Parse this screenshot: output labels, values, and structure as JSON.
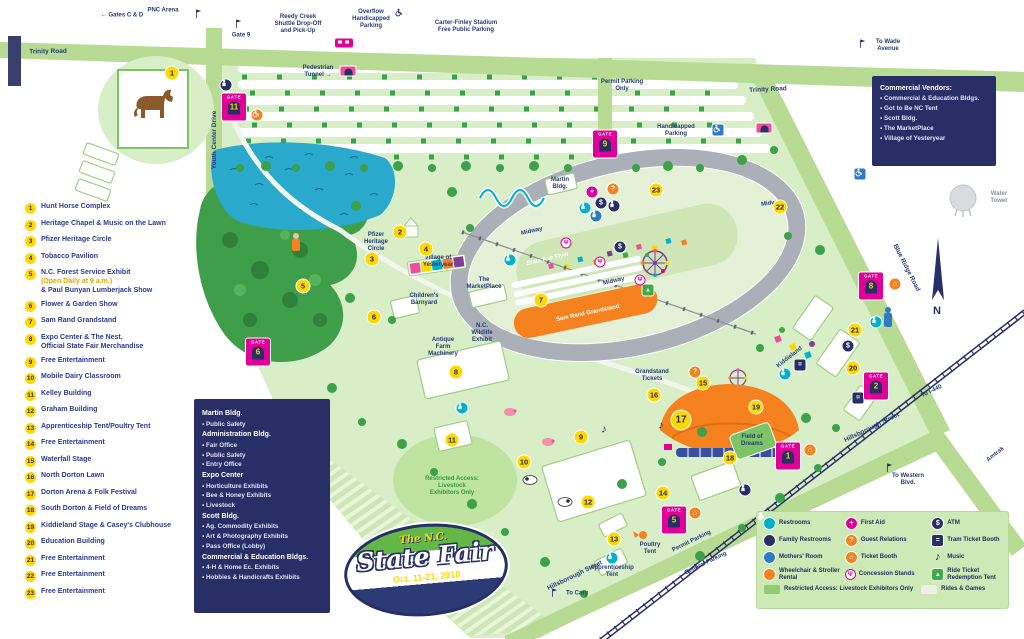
{
  "colors": {
    "navy": "#272f66",
    "magenta": "#e10098",
    "yellow": "#ffd800",
    "orange": "#f5821f",
    "teal": "#00b2c9",
    "blue": "#2e7bc4",
    "green": "#3faa4a",
    "road_green": "#b7db93",
    "fairground_green": "#d8eec6",
    "lake_blue": "#29a9cc"
  },
  "logo": {
    "top": "The N.C.",
    "main": "State Fair",
    "date": "Oct. 11-21, 2018"
  },
  "key": [
    {
      "n": "1",
      "label": "Hunt Horse Complex"
    },
    {
      "n": "2",
      "label": "Heritage Chapel & Music on the Lawn"
    },
    {
      "n": "3",
      "label": "Pfizer Heritage Circle"
    },
    {
      "n": "4",
      "label": "Tobacco Pavilion"
    },
    {
      "n": "5",
      "label": "N.C. Forest Service Exhibit",
      "note": "(Open Daily at 9 a.m.)",
      "label2": "& Paul Bunyan Lumberjack Show"
    },
    {
      "n": "6",
      "label": "Flower & Garden Show"
    },
    {
      "n": "7",
      "label": "Sam Rand Grandstand"
    },
    {
      "n": "8",
      "label": "Expo Center & The Nest,\nOfficial State Fair Merchandise"
    },
    {
      "n": "9",
      "label": "Free Entertainment"
    },
    {
      "n": "10",
      "label": "Mobile Dairy Classroom"
    },
    {
      "n": "11",
      "label": "Kelley Building"
    },
    {
      "n": "12",
      "label": "Graham Building"
    },
    {
      "n": "13",
      "label": "Apprenticeship Tent/Poultry Tent"
    },
    {
      "n": "14",
      "label": "Free Entertainment"
    },
    {
      "n": "15",
      "label": "Waterfall Stage"
    },
    {
      "n": "16",
      "label": "North Dorton Lawn"
    },
    {
      "n": "17",
      "label": "Dorton Arena & Folk Festival"
    },
    {
      "n": "18",
      "label": "South Dorton & Field of Dreams"
    },
    {
      "n": "19",
      "label": "Kiddieland Stage & Casey's Clubhouse"
    },
    {
      "n": "20",
      "label": "Education Building"
    },
    {
      "n": "21",
      "label": "Free Entertainment"
    },
    {
      "n": "22",
      "label": "Free Entertainment"
    },
    {
      "n": "23",
      "label": "Free Entertainment"
    }
  ],
  "buildings_box": {
    "groups": [
      {
        "name": "Martin Bldg.",
        "items": [
          "Public Safety"
        ]
      },
      {
        "name": "Administration Bldg.",
        "items": [
          "Fair Office",
          "Public Safety",
          "Entry Office"
        ]
      },
      {
        "name": "Expo Center",
        "items": [
          "Horticulture Exhibits",
          "Bee & Honey Exhibits",
          "Livestock"
        ]
      },
      {
        "name": "Scott Bldg.",
        "items": [
          "Ag. Commodity Exhibits",
          "Art & Photography Exhibits",
          "Pass Office (Lobby)"
        ]
      },
      {
        "name": "Commercial & Education Bldgs.",
        "items": [
          "4-H & Home Ec. Exhibits",
          "Hobbies & Handicrafts Exhibits"
        ]
      }
    ]
  },
  "vendors_box": {
    "title": "Commercial Vendors:",
    "items": [
      "Commercial & Education Bldgs.",
      "Got to Be NC Tent",
      "Scott Bldg.",
      "The MarketPlace",
      "Village of Yesteryear"
    ]
  },
  "legend": {
    "items": [
      {
        "type": "rr",
        "label": "Restrooms"
      },
      {
        "type": "aid",
        "label": "First Aid"
      },
      {
        "type": "atm",
        "label": "ATM"
      },
      {
        "type": "fam",
        "label": "Family Restrooms"
      },
      {
        "type": "gr",
        "label": "Guest Relations"
      },
      {
        "type": "tram",
        "label": "Tram Ticket Booth"
      },
      {
        "type": "mom",
        "label": "Mothers' Room"
      },
      {
        "type": "tk",
        "label": "Ticket Booth"
      },
      {
        "type": "music",
        "label": "Music"
      },
      {
        "type": "wc",
        "label": "Wheelchair & Stroller Rental"
      },
      {
        "type": "con",
        "label": "Concession Stands"
      },
      {
        "type": "ride",
        "label": "Ride Ticket Redemption Tent"
      }
    ],
    "swatches": [
      {
        "label": "Restricted Access: Livestock Exhibitors Only",
        "color": "#93cc72"
      },
      {
        "label": "Rides & Games",
        "color": "#edf1e4"
      }
    ]
  },
  "labels": [
    {
      "t": "← Gates C & D",
      "x": 122,
      "y": 16
    },
    {
      "t": "PNC Arena",
      "x": 163,
      "y": 11
    },
    {
      "t": "Gate 9",
      "x": 241,
      "y": 36
    },
    {
      "t": "Reedy Creek\nShuttle Drop-Off\nand Pick-Up",
      "x": 298,
      "y": 25
    },
    {
      "t": "Overflow\nHandicapped\nParking",
      "x": 371,
      "y": 20
    },
    {
      "t": "Carter-Finley Stadium\nFree Public Parking",
      "x": 466,
      "y": 27
    },
    {
      "t": "To Wade\nAvenue",
      "x": 888,
      "y": 46
    },
    {
      "t": "Trinity Road",
      "x": 48,
      "y": 52,
      "r": -1,
      "c": "road"
    },
    {
      "t": "Trinity Road",
      "x": 768,
      "y": 90,
      "r": -3,
      "c": "road"
    },
    {
      "t": "Youth Center Drive",
      "x": 215,
      "y": 140,
      "r": -90,
      "c": "road"
    },
    {
      "t": "Blue Ridge Road",
      "x": 906,
      "y": 268,
      "r": 63,
      "c": "road"
    },
    {
      "t": "Hillsborough Street",
      "x": 575,
      "y": 576,
      "r": -26,
      "c": "road"
    },
    {
      "t": "Hillsborough Street",
      "x": 872,
      "y": 428,
      "r": -26,
      "c": "road"
    },
    {
      "t": "To Cary",
      "x": 577,
      "y": 594
    },
    {
      "t": "To Western\nBlvd.",
      "x": 908,
      "y": 480
    },
    {
      "t": "To I-440",
      "x": 932,
      "y": 392,
      "r": -26
    },
    {
      "t": "Permit Parking",
      "x": 692,
      "y": 542,
      "r": -26
    },
    {
      "t": "General Parking",
      "x": 706,
      "y": 564,
      "r": -26
    },
    {
      "t": "Amtrak",
      "x": 996,
      "y": 455,
      "r": -38
    },
    {
      "t": "Pedestrian\nTunnel →",
      "x": 318,
      "y": 72
    },
    {
      "t": "Water Tower",
      "x": 999,
      "y": 198,
      "c": "gray"
    },
    {
      "t": "Handicapped\nParking",
      "x": 676,
      "y": 131
    },
    {
      "t": "Permit Parking\nOnly",
      "x": 622,
      "y": 86
    },
    {
      "t": "Martin\nBldg.",
      "x": 560,
      "y": 184
    },
    {
      "t": "Midway",
      "x": 532,
      "y": 232,
      "r": -13
    },
    {
      "t": "State Fair Flyer",
      "x": 548,
      "y": 260,
      "r": -13,
      "c": "white"
    },
    {
      "t": "Midway",
      "x": 614,
      "y": 282,
      "r": -13
    },
    {
      "t": "Midway",
      "x": 772,
      "y": 204,
      "r": -8
    },
    {
      "t": "Sam Rand Grandstand",
      "x": 588,
      "y": 314,
      "r": -12,
      "c": "white"
    },
    {
      "t": "Pfizer\nHeritage\nCircle",
      "x": 376,
      "y": 243
    },
    {
      "t": "Village of\nYesteryear",
      "x": 438,
      "y": 262
    },
    {
      "t": "The\nMarketPlace",
      "x": 484,
      "y": 284
    },
    {
      "t": "Children's\nBarnyard",
      "x": 424,
      "y": 300
    },
    {
      "t": "N.C.\nWildlife\nExhibit",
      "x": 482,
      "y": 334
    },
    {
      "t": "Antique\nFarm\nMachinery",
      "x": 443,
      "y": 348
    },
    {
      "t": "Grandstand\nTickets",
      "x": 652,
      "y": 376
    },
    {
      "t": "Field of\nDreams",
      "x": 752,
      "y": 441
    },
    {
      "t": "Kiddieland",
      "x": 790,
      "y": 358,
      "r": -38
    },
    {
      "t": "Restricted Access:\nLivestock\nExhibitors Only",
      "x": 452,
      "y": 487,
      "c": "green"
    },
    {
      "t": "Apprenticeship\nTent",
      "x": 612,
      "y": 572
    },
    {
      "t": "Poultry\nTent",
      "x": 650,
      "y": 549
    }
  ],
  "numbers": [
    {
      "n": "1",
      "x": 172,
      "y": 73
    },
    {
      "n": "2",
      "x": 400,
      "y": 232
    },
    {
      "n": "3",
      "x": 372,
      "y": 259
    },
    {
      "n": "4",
      "x": 426,
      "y": 249
    },
    {
      "n": "5",
      "x": 303,
      "y": 286
    },
    {
      "n": "6",
      "x": 374,
      "y": 317
    },
    {
      "n": "7",
      "x": 541,
      "y": 300
    },
    {
      "n": "8",
      "x": 456,
      "y": 372
    },
    {
      "n": "9",
      "x": 581,
      "y": 437
    },
    {
      "n": "10",
      "x": 524,
      "y": 462
    },
    {
      "n": "11",
      "x": 452,
      "y": 440
    },
    {
      "n": "12",
      "x": 588,
      "y": 502
    },
    {
      "n": "13",
      "x": 614,
      "y": 539
    },
    {
      "n": "14",
      "x": 663,
      "y": 493
    },
    {
      "n": "15",
      "x": 703,
      "y": 383
    },
    {
      "n": "16",
      "x": 654,
      "y": 395
    },
    {
      "n": "17",
      "x": 681,
      "y": 420,
      "s": 19
    },
    {
      "n": "18",
      "x": 730,
      "y": 458
    },
    {
      "n": "19",
      "x": 756,
      "y": 407
    },
    {
      "n": "20",
      "x": 853,
      "y": 368
    },
    {
      "n": "21",
      "x": 855,
      "y": 330
    },
    {
      "n": "22",
      "x": 780,
      "y": 207
    },
    {
      "n": "23",
      "x": 656,
      "y": 190
    }
  ],
  "gates": [
    {
      "n": "11",
      "x": 234,
      "y": 107
    },
    {
      "n": "9",
      "x": 605,
      "y": 144
    },
    {
      "n": "6",
      "x": 258,
      "y": 352
    },
    {
      "n": "8",
      "x": 871,
      "y": 286
    },
    {
      "n": "2",
      "x": 876,
      "y": 386
    },
    {
      "n": "1",
      "x": 788,
      "y": 456
    },
    {
      "n": "5",
      "x": 674,
      "y": 520
    }
  ],
  "icons": [
    {
      "t": "flag",
      "x": 200,
      "y": 14
    },
    {
      "t": "flag",
      "x": 240,
      "y": 24
    },
    {
      "t": "flag",
      "x": 864,
      "y": 44
    },
    {
      "t": "flag",
      "x": 556,
      "y": 593
    },
    {
      "t": "flag",
      "x": 891,
      "y": 468
    },
    {
      "t": "wc-navy",
      "x": 400,
      "y": 14
    },
    {
      "t": "wc-blue",
      "x": 718,
      "y": 130
    },
    {
      "t": "wc-blue",
      "x": 860,
      "y": 174
    },
    {
      "t": "tunnel",
      "x": 348,
      "y": 71
    },
    {
      "t": "tunnel",
      "x": 764,
      "y": 128
    },
    {
      "t": "bus",
      "x": 344,
      "y": 43
    },
    {
      "t": "rr",
      "x": 510,
      "y": 260
    },
    {
      "t": "rr",
      "x": 585,
      "y": 208
    },
    {
      "t": "rr",
      "x": 785,
      "y": 374
    },
    {
      "t": "rr",
      "x": 612,
      "y": 558
    },
    {
      "t": "rr",
      "x": 462,
      "y": 408
    },
    {
      "t": "rr",
      "x": 876,
      "y": 322
    },
    {
      "t": "fam",
      "x": 614,
      "y": 206
    },
    {
      "t": "fam",
      "x": 226,
      "y": 85
    },
    {
      "t": "fam",
      "x": 745,
      "y": 490
    },
    {
      "t": "mom",
      "x": 596,
      "y": 216
    },
    {
      "t": "aid",
      "x": 592,
      "y": 192
    },
    {
      "t": "atm",
      "x": 601,
      "y": 203
    },
    {
      "t": "atm",
      "x": 620,
      "y": 247
    },
    {
      "t": "atm",
      "x": 848,
      "y": 346
    },
    {
      "t": "gr",
      "x": 613,
      "y": 189
    },
    {
      "t": "gr",
      "x": 695,
      "y": 372
    },
    {
      "t": "tk",
      "x": 895,
      "y": 284
    },
    {
      "t": "tk",
      "x": 810,
      "y": 450
    },
    {
      "t": "tk",
      "x": 695,
      "y": 513
    },
    {
      "t": "wc",
      "x": 257,
      "y": 115
    },
    {
      "t": "tram",
      "x": 800,
      "y": 365
    },
    {
      "t": "tram",
      "x": 858,
      "y": 398
    },
    {
      "t": "ride",
      "x": 648,
      "y": 290
    },
    {
      "t": "music",
      "x": 661,
      "y": 426
    },
    {
      "t": "music",
      "x": 604,
      "y": 430
    },
    {
      "t": "con",
      "x": 566,
      "y": 243
    },
    {
      "t": "con",
      "x": 600,
      "y": 262
    },
    {
      "t": "con",
      "x": 640,
      "y": 280
    }
  ]
}
